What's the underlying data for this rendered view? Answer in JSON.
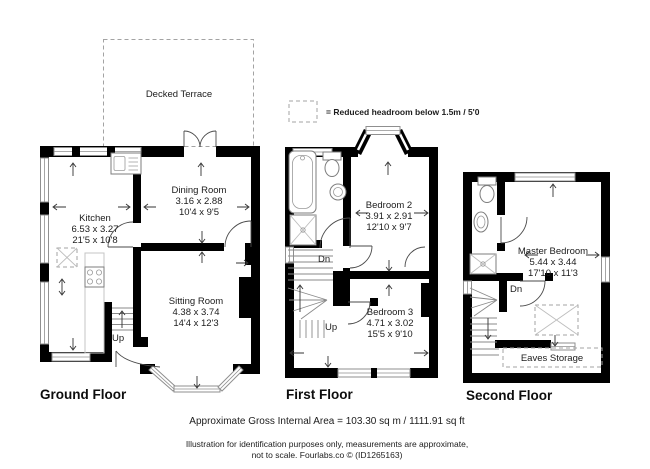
{
  "terrace": {
    "label": "Decked Terrace"
  },
  "legend": {
    "text": "= Reduced headroom below 1.5m / 5'0"
  },
  "floors": [
    {
      "title": "Ground Floor",
      "rooms": [
        {
          "name": "Kitchen",
          "metric": "6.53 x 3.27",
          "imperial": "21'5 x 10'8"
        },
        {
          "name": "Dining Room",
          "metric": "3.16 x 2.88",
          "imperial": "10'4 x 9'5"
        },
        {
          "name": "Sitting Room",
          "metric": "4.38 x 3.74",
          "imperial": "14'4 x 12'3"
        }
      ],
      "stair_up": "Up"
    },
    {
      "title": "First Floor",
      "rooms": [
        {
          "name": "Bedroom 2",
          "metric": "3.91 x 2.91",
          "imperial": "12'10 x 9'7"
        },
        {
          "name": "Bedroom 3",
          "metric": "4.71 x 3.02",
          "imperial": "15'5 x 9'10"
        }
      ],
      "stair_up": "Up",
      "stair_dn": "Dn"
    },
    {
      "title": "Second Floor",
      "rooms": [
        {
          "name": "Master Bedroom",
          "metric": "5.44 x 3.44",
          "imperial": "17'10 x 11'3"
        }
      ],
      "stair_dn": "Dn",
      "eaves_label": "Eaves Storage"
    }
  ],
  "footer": {
    "area": "Approximate Gross Internal Area = 103.30 sq m / 1111.91 sq ft",
    "disclaimer1": "Illustration for identification purposes only, measurements are approximate,",
    "disclaimer2": "not to scale. Fourlabs.co © (ID1265163)"
  },
  "colors": {
    "wall": "#000000",
    "window_frame": "#8f8f8f",
    "dashed": "#a3a3a3",
    "text": "#1c1c1c"
  }
}
